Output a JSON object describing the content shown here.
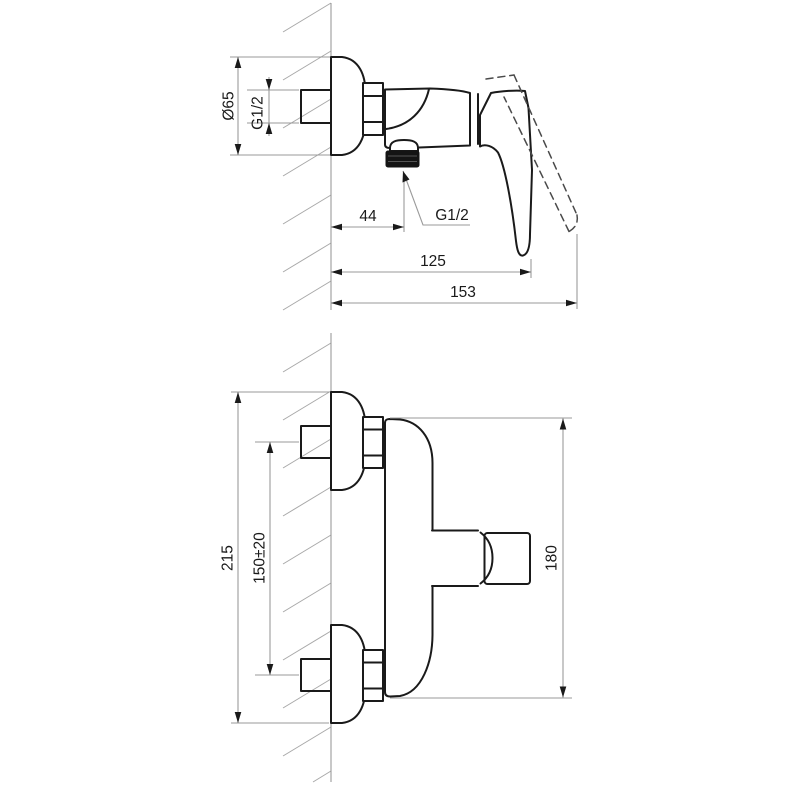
{
  "drawing": {
    "subject": "wall-mounted-single-lever-shower-mixer-dimension-drawing",
    "side_view": {
      "dims": {
        "flange_diameter": "Ø65",
        "inlet_thread": "G1/2",
        "outlet_offset": "44",
        "outlet_thread": "G1/2",
        "depth_to_lever": "125",
        "overall_depth": "153"
      }
    },
    "front_view": {
      "dims": {
        "overall_height": "215",
        "inlet_spacing": "150±20",
        "body_height": "180"
      }
    },
    "colors": {
      "outline": "#1a1a1a",
      "thin_line": "#9a9a9a",
      "text": "#1a1a1a",
      "knurl_fill": "#141414",
      "background": "#ffffff"
    }
  }
}
